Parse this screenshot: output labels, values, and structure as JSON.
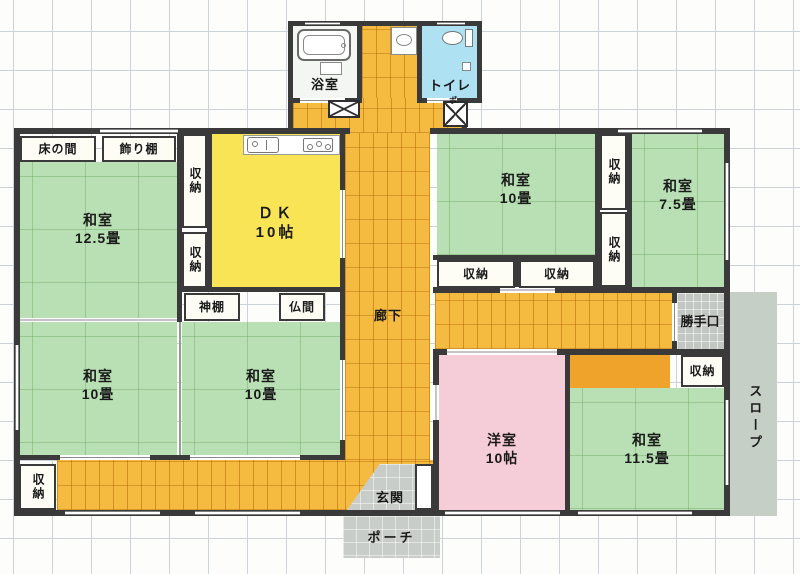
{
  "labels": {
    "storage": "収納",
    "corridor": "廊下",
    "tokonoma": "床の間",
    "kazaridana": "飾り棚",
    "kamidana": "神棚",
    "butsuma": "仏間",
    "bath": "浴室",
    "toilet": "トイレ",
    "backdoor": "勝手口",
    "slope": "スロープ",
    "entrance": "玄関",
    "porch": "ポーチ",
    "boiler_mark": "ポ"
  },
  "rooms": {
    "washitsu_125": {
      "name": "和室",
      "size": "12.5畳"
    },
    "dk": {
      "name": "ＤＫ",
      "size": "10帖"
    },
    "washitsu_10_ne": {
      "name": "和室",
      "size": "10畳"
    },
    "washitsu_75": {
      "name": "和室",
      "size": "7.5畳"
    },
    "washitsu_10_sw1": {
      "name": "和室",
      "size": "10畳"
    },
    "washitsu_10_sw2": {
      "name": "和室",
      "size": "10畳"
    },
    "youshitsu": {
      "name": "洋室",
      "size": "10帖"
    },
    "washitsu_115": {
      "name": "和室",
      "size": "11.5畳"
    }
  },
  "colors": {
    "tatami_green": "#b9e0b4",
    "corridor_orange": "#f5bb41",
    "dk_yellow": "#f8e455",
    "western_pink": "#f5cdd8",
    "toilet_blue": "#aee1f2",
    "closet_orange": "#f0a32a",
    "gray_tile": "#c9cdc9",
    "wall": "#3a3a3a"
  }
}
